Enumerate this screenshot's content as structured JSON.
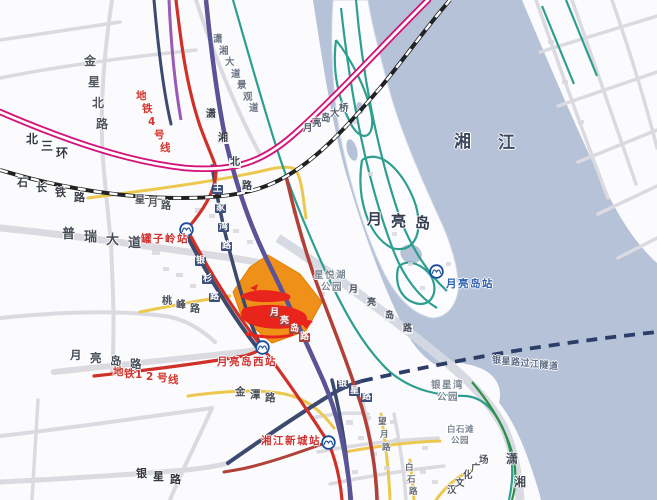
{
  "colors": {
    "water": "#b5c2d8",
    "land": "#fbfbfd",
    "minor_road": "#dadae0",
    "yellow_road": "#ecc94e",
    "greenway_teal": "#2e9e8f",
    "green_line": "#2f8f45",
    "ring_road_magenta": "#d4147a",
    "railway_black": "#222222",
    "metro_red": "#cf3128",
    "arterial_crimson": "#b04038",
    "trunk_indigo": "#5a5496",
    "navy_road": "#3b4a6e",
    "tunnel_dash_navy": "#2c3e68",
    "orange_plot": "#ef9118",
    "scribble_red": "#e8241c",
    "station_red_text": "#d03030",
    "station_blue_text": "#2b5fb0"
  },
  "highlight": {
    "plot_color": "#ef9118",
    "annotation_type": "hand-drawn red scribble (illegible)",
    "scribble_color": "#e8241c"
  },
  "stations": [
    {
      "id": "guanziling",
      "name": "罐子岭站",
      "color": "#d03030",
      "logo": {
        "x": 186,
        "y": 229
      },
      "label": {
        "x": 141,
        "y": 234,
        "size": 10.5
      }
    },
    {
      "id": "yueliangdao-xi",
      "name": "月亮岛西站",
      "color": "#d03030",
      "logo": {
        "x": 262,
        "y": 347
      },
      "label": {
        "x": 217,
        "y": 357,
        "size": 10.5
      }
    },
    {
      "id": "yueliangdao",
      "name": "月亮岛站",
      "color": "#2b5fb0",
      "logo": {
        "x": 436,
        "y": 271
      },
      "label": {
        "x": 446,
        "y": 279,
        "size": 10.5
      }
    },
    {
      "id": "xiangjiang-xincheng",
      "name": "湘江新城站",
      "color": "#d03030",
      "logo": {
        "x": 328,
        "y": 442
      },
      "label": {
        "x": 261,
        "y": 436,
        "size": 10.5
      }
    }
  ],
  "labels": [
    {
      "id": "jinxing-beilu",
      "text": "金星北路",
      "x": 84,
      "y": 55,
      "size": 12,
      "color": "#50555e",
      "step": [
        4,
        21
      ]
    },
    {
      "id": "beisanhuan",
      "text": "北三环",
      "x": 26,
      "y": 133,
      "size": 12,
      "color": "#333a45",
      "step": [
        15,
        7
      ],
      "bold": true
    },
    {
      "id": "shichang-tielu",
      "text": "石长铁路",
      "x": 17,
      "y": 177,
      "size": 11,
      "color": "#3a3f49",
      "step": [
        19,
        5
      ]
    },
    {
      "id": "xingyue-lu",
      "text": "星月路",
      "x": 135,
      "y": 196,
      "size": 10,
      "color": "#4a4f58",
      "step": [
        13,
        3
      ]
    },
    {
      "id": "purui-dadao",
      "text": "普瑞大道",
      "x": 62,
      "y": 228,
      "size": 13,
      "color": "#474d58",
      "step": [
        22,
        3
      ]
    },
    {
      "id": "ditie-4-haoxian",
      "text": "地铁4号线",
      "x": 136,
      "y": 91,
      "size": 10.5,
      "color": "#d2332b",
      "step": [
        6,
        13
      ]
    },
    {
      "id": "xiaoxiang-dadao-jingguandao",
      "text": "潇湘大道景观道",
      "x": 213,
      "y": 35,
      "size": 9.5,
      "color": "#6b7686",
      "step": [
        6,
        11.5
      ]
    },
    {
      "id": "xiaoxiang-beilu",
      "text": "潇湘北路",
      "x": 205,
      "y": 110,
      "size": 10,
      "color": "#3a3f49",
      "step": [
        12,
        24
      ],
      "bg": "#f2f2f5"
    },
    {
      "id": "yueliangdao-daqiao",
      "text": "月亮岛大桥",
      "x": 303,
      "y": 124,
      "size": 9.5,
      "color": "#555e6e",
      "step": [
        9,
        -5
      ]
    },
    {
      "id": "wangjiawan-lu",
      "text": "王家湾路",
      "x": 212,
      "y": 185,
      "size": 9,
      "color": "#ffffff",
      "step": [
        3,
        19
      ],
      "bg": "#3c4f78"
    },
    {
      "id": "yinshan-lu",
      "text": "银杉路",
      "x": 195,
      "y": 257,
      "size": 9,
      "color": "#ffffff",
      "step": [
        7,
        18
      ],
      "bg": "#3c4f78"
    },
    {
      "id": "taofeng-lu",
      "text": "桃峰路",
      "x": 162,
      "y": 297,
      "size": 10,
      "color": "#4a4f58",
      "step": [
        14,
        4
      ]
    },
    {
      "id": "yueliangdao-lu-ne",
      "text": "月亮岛路",
      "x": 269,
      "y": 309,
      "size": 9,
      "color": "#ffffff",
      "step": [
        10,
        8
      ],
      "bg": "#a8403c"
    },
    {
      "id": "yueliangdao-lu-west",
      "text": "月亮岛路",
      "x": 70,
      "y": 350,
      "size": 11.5,
      "color": "#474d58",
      "step": [
        20,
        3
      ]
    },
    {
      "id": "ditie-12-haoxian",
      "text": "地铁12号线",
      "x": 113,
      "y": 367,
      "size": 10.5,
      "color": "#d2332b",
      "step": [
        11,
        1.5
      ]
    },
    {
      "id": "jintan-lu",
      "text": "金潭路",
      "x": 235,
      "y": 387,
      "size": 10.5,
      "color": "#4a4f58",
      "step": [
        15,
        3
      ]
    },
    {
      "id": "yinxing-lu-sw",
      "text": "银星路",
      "x": 136,
      "y": 468,
      "size": 11,
      "color": "#33383f",
      "step": [
        17,
        3
      ],
      "bold": true
    },
    {
      "id": "yinxing-lu-boxed",
      "text": "银星路",
      "x": 337,
      "y": 380,
      "size": 9,
      "color": "#ffffff",
      "step": [
        12,
        6.5
      ],
      "bg": "#3c4f78"
    },
    {
      "id": "wangyue-lu",
      "text": "望月路",
      "x": 378,
      "y": 418,
      "size": 8.5,
      "color": "#666c76",
      "step": [
        2,
        13
      ]
    },
    {
      "id": "baishi-lu",
      "text": "白石路",
      "x": 405,
      "y": 464,
      "size": 8.5,
      "color": "#666c76",
      "step": [
        2,
        12
      ]
    },
    {
      "id": "xiangjiang-river",
      "text": "湘江",
      "x": 454,
      "y": 134,
      "size": 17,
      "color": "#3c4960",
      "step": [
        44,
        1
      ],
      "bold": true
    },
    {
      "id": "yueliangdao-island",
      "text": "月亮岛",
      "x": 367,
      "y": 212,
      "size": 15,
      "color": "#333c4e",
      "step": [
        24,
        2
      ],
      "bold": true
    },
    {
      "id": "xingyuehu-gongyuan",
      "text": "星悦湖公园",
      "x": 314,
      "y": 271,
      "size": 9.5,
      "color": "#7c8794",
      "step": [
        11,
        0
      ],
      "wrap": 3,
      "indent": 7,
      "lineh": 12
    },
    {
      "id": "yinxingwan-gongyuan",
      "text": "银星湾公园",
      "x": 431,
      "y": 381,
      "size": 9.5,
      "color": "#7c8794",
      "step": [
        11,
        0
      ],
      "wrap": 3,
      "indent": 6,
      "lineh": 12
    },
    {
      "id": "baishitan-gongyuan",
      "text": "白石滩公园",
      "x": 447,
      "y": 426,
      "size": 8.5,
      "color": "#7c8794",
      "step": [
        9,
        0
      ],
      "wrap": 3,
      "indent": 4,
      "lineh": 11
    },
    {
      "id": "hanwenhua-guangchang",
      "text": "汉文化广场",
      "x": 447,
      "y": 486,
      "size": 9.5,
      "color": "#50555e",
      "step": [
        8,
        -7.5
      ]
    },
    {
      "id": "xiaoxiang-partial",
      "text": "潇湘",
      "x": 506,
      "y": 453,
      "size": 12,
      "color": "#454c58",
      "step": [
        8,
        23
      ]
    },
    {
      "id": "yinxinglu-guojiang-suidao",
      "text": "银星路过江隧道",
      "x": 492,
      "y": 357,
      "size": 9,
      "color": "#5b6b84",
      "step": [
        9.5,
        1
      ]
    },
    {
      "id": "yueliangdao-lu-crossing",
      "text": "月亮岛路",
      "x": 348,
      "y": 286,
      "size": 9,
      "color": "#474d58",
      "step": [
        18,
        13
      ],
      "bg": "#eceff4"
    }
  ]
}
